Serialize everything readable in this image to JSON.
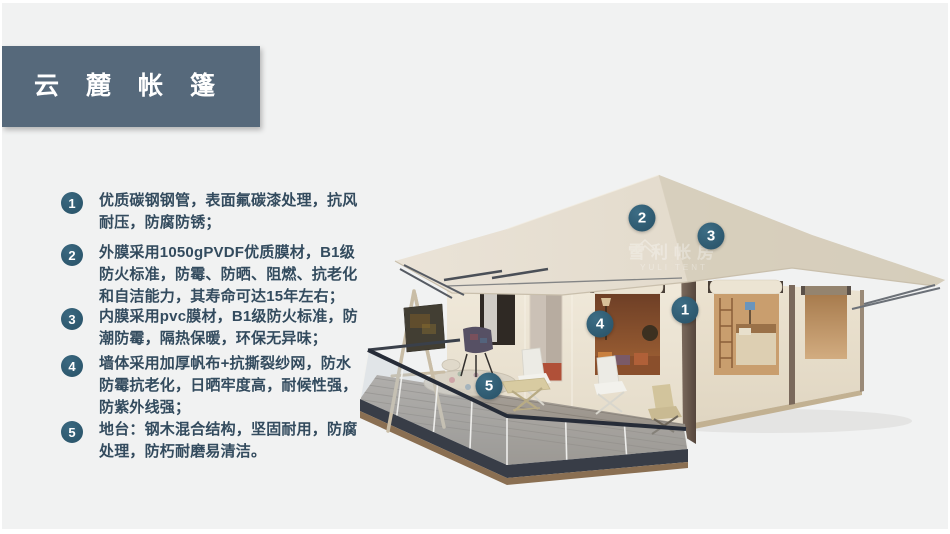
{
  "slide": {
    "header": {
      "title": "云麓帐篷"
    },
    "features": [
      {
        "number": "1",
        "text": "优质碳钢钢管，表面氟碳漆处理，抗风耐压，防腐防锈；"
      },
      {
        "number": "2",
        "text": "外膜采用1050gPVDF优质膜材，B1级防火标准，防霉、防晒、阻燃、抗老化和自洁能力，其寿命可达15年左右；"
      },
      {
        "number": "3",
        "text": "内膜采用pvc膜材，B1级防火标准，防潮防霉，隔热保暖，环保无异味；"
      },
      {
        "number": "4",
        "text": "墙体采用加厚帆布+抗撕裂纱网，防水防霉抗老化，日晒牢度高，耐候性强，防紫外线强；"
      },
      {
        "number": "5",
        "text": "地台：钢木混合结构，坚固耐用，防腐处理，防朽耐磨易清洁。"
      }
    ],
    "illustration": {
      "watermark": {
        "cn": "雪利帐房",
        "en": "YULI TENT"
      },
      "markers": [
        {
          "label": "1",
          "x": 333,
          "y": 182
        },
        {
          "label": "2",
          "x": 290,
          "y": 90
        },
        {
          "label": "3",
          "x": 359,
          "y": 108
        },
        {
          "label": "4",
          "x": 248,
          "y": 196
        },
        {
          "label": "5",
          "x": 137,
          "y": 258
        }
      ]
    },
    "colors": {
      "banner": "#56697b",
      "badge": "#2d586e",
      "marker": "#2d586e",
      "text": "#334b5e",
      "background": "#f1f2f2"
    }
  }
}
